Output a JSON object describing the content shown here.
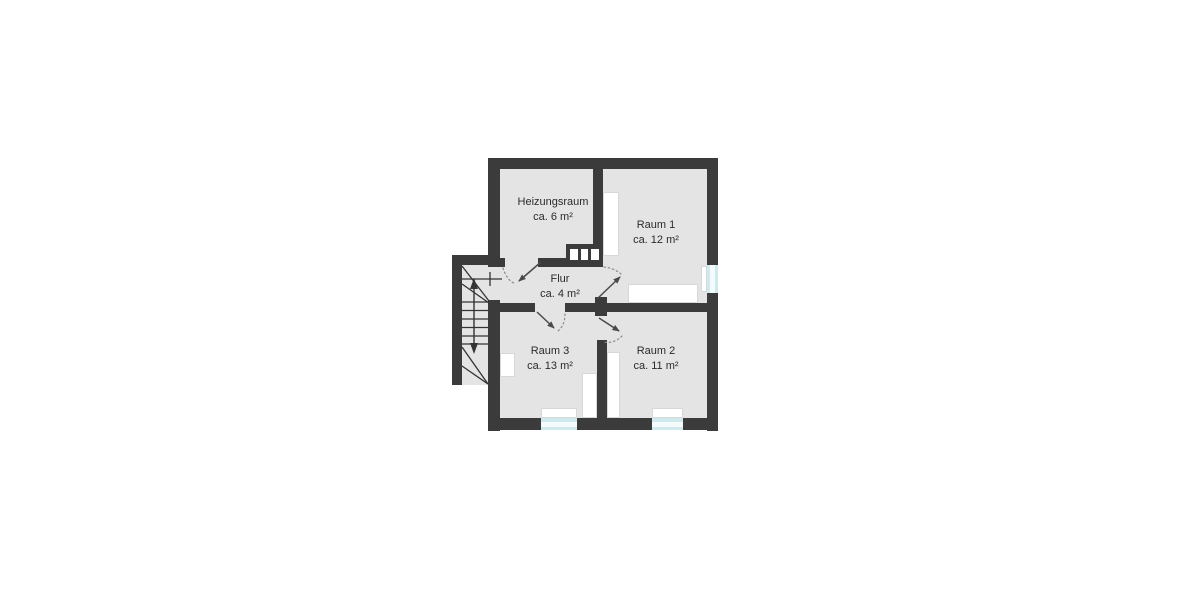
{
  "plan": {
    "rooms": [
      {
        "key": "heizungsraum",
        "name": "Heizungsraum",
        "area": "ca. 6 m²"
      },
      {
        "key": "raum1",
        "name": "Raum 1",
        "area": "ca. 12 m²"
      },
      {
        "key": "flur",
        "name": "Flur",
        "area": "ca. 4 m²"
      },
      {
        "key": "raum3",
        "name": "Raum 3",
        "area": "ca. 13 m²"
      },
      {
        "key": "raum2",
        "name": "Raum 2",
        "area": "ca. 11 m²"
      }
    ],
    "colors": {
      "wall": "#3b3b3b",
      "floor": "#e4e4e4",
      "window_frame": "#cfe9ec",
      "window_glass": "#f4fbfc",
      "door_line": "#4a4a4a",
      "background": "#ffffff"
    }
  }
}
